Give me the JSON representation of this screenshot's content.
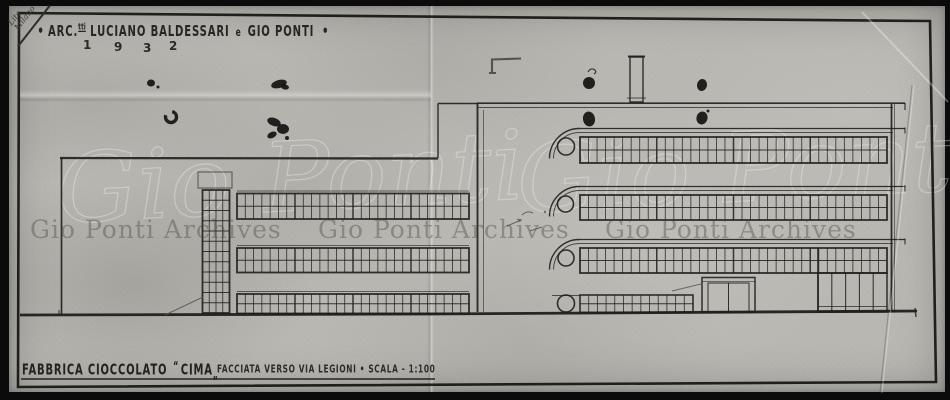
{
  "title_block": {
    "bullet_left": "•",
    "architects_prefix": "ARC.",
    "architects_sup": "tti",
    "architects_name1": "LUCIANO BALDESSARI",
    "conjunction": "e",
    "architects_name2": "GIO PONTI",
    "bullet_right": "•",
    "year_digits": [
      "1",
      "9",
      "3",
      "2"
    ]
  },
  "caption": {
    "project": "FABBRICA CIOCCOLATO",
    "quote_open": "“",
    "project_name": "CIMA",
    "quote_close": "„",
    "subtitle": "FACCIATA VERSO VIA LEGIONI",
    "separator": "•",
    "scale_label": "SCALA - 1:100"
  },
  "corner_note": {
    "line1": "Lita",
    "line2": "Milano"
  },
  "watermarks": {
    "archive_text": "Gio Ponti Archives",
    "script_signature": "Gio Ponti"
  },
  "colors": {
    "ink": "#1f1f1d",
    "ink_soft": "#45423c",
    "pencil": "#56534c",
    "blob": "#121210",
    "paper": "#bab8b2",
    "photo_background": "#0b0b0b"
  }
}
